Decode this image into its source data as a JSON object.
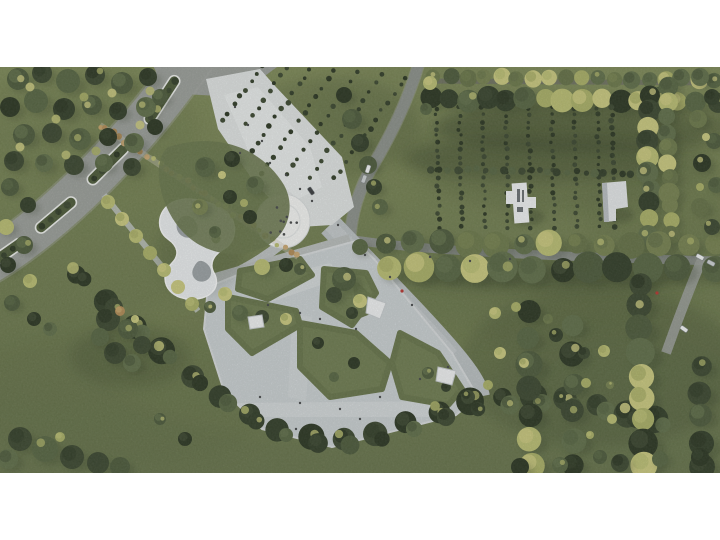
{
  "meta": {
    "title": "Aerial rendering of a park landscape master plan",
    "description": "Top-down photorealistic site-plan rendering of a public park: a diagonal arterial road with planted median islands at the upper left, a white entry plaza leading to a circular white gathering plaza, a curved white pump-track loop, a large paved south plaza with rounded lawn islands and small white canopies, diagonal hedge rows and an orchard grid with two small white buildings on the right, a tree-lined east-west avenue, and dense perimeter tree belts. White letterbox bands frame the image top and bottom."
  },
  "features": [
    {
      "name": "main-road",
      "desc": "diagonal asphalt road with white-edged planted median islands"
    },
    {
      "name": "median-islands",
      "desc": "oval green medians with small trees outlined in white"
    },
    {
      "name": "entry-plaza",
      "desc": "white concrete entrance plaza east of the road"
    },
    {
      "name": "autumn-allee",
      "desc": "diagonal band of tan autumn trees crossing the road into the park"
    },
    {
      "name": "circular-plaza",
      "desc": "white circular plaza with scattered visitors"
    },
    {
      "name": "pump-track",
      "desc": "white S-shaped looping track with gray infield"
    },
    {
      "name": "south-plaza",
      "desc": "large paved plaza with rounded lawn islands and walkways"
    },
    {
      "name": "lawn-islands",
      "desc": "grass islands with specimen trees inside the paved plaza"
    },
    {
      "name": "pavilions",
      "desc": "small white angular canopy structures"
    },
    {
      "name": "nw-orchard",
      "desc": "diagonal hedge rows north of the entry plaza"
    },
    {
      "name": "east-orchard",
      "desc": "grid of shrub rows with two white buildings"
    },
    {
      "name": "avenue",
      "desc": "east-west road lined with large trees"
    },
    {
      "name": "hedge-belt",
      "desc": "continuous dark hedge and tree belt along the south-west edge"
    },
    {
      "name": "vehicles",
      "desc": "small white, silver and dark cars on the roads"
    }
  ],
  "palette": {
    "frame_white": "#ffffff",
    "grass_base": "#6e7b4e",
    "grass_light": "#7d8957",
    "grass_dark": "#5a6741",
    "shadow": "#25301c",
    "asphalt": "#9a9e99",
    "asphalt_dark": "#8b908a",
    "asphalt_edge": "#a4a8a2",
    "concrete": "#c9cfd1",
    "concrete_light": "#e9eceb",
    "plaza_white": "#f3f4f2",
    "track_white": "#e9eced",
    "track_gray": "#9aa0a3",
    "median_green": "#4c5a38",
    "median_stroke": "#edefec",
    "path_light": "#c3c8c5",
    "tree_dark": [
      "#323e28",
      "#3b472f",
      "#2b3622"
    ],
    "tree_mid": [
      "#566542",
      "#5f6e49",
      "#4c5a3b"
    ],
    "tree_olive": [
      "#6b784a",
      "#75814f",
      "#647146"
    ],
    "tree_yellow": [
      "#b9bd72",
      "#c9c87e",
      "#a9af66"
    ],
    "tree_tan": [
      "#c4a268",
      "#b08b55",
      "#caa873"
    ],
    "building_white": "#eef0f1",
    "building_side": "#b9bec2",
    "building_slot": "#6a6f72",
    "car_white": "#f2f4f4",
    "car_silver": "#ccd1d2",
    "car_dark": "#3a3d3f",
    "people": "#46494a",
    "accent_red": "#b5352f"
  }
}
